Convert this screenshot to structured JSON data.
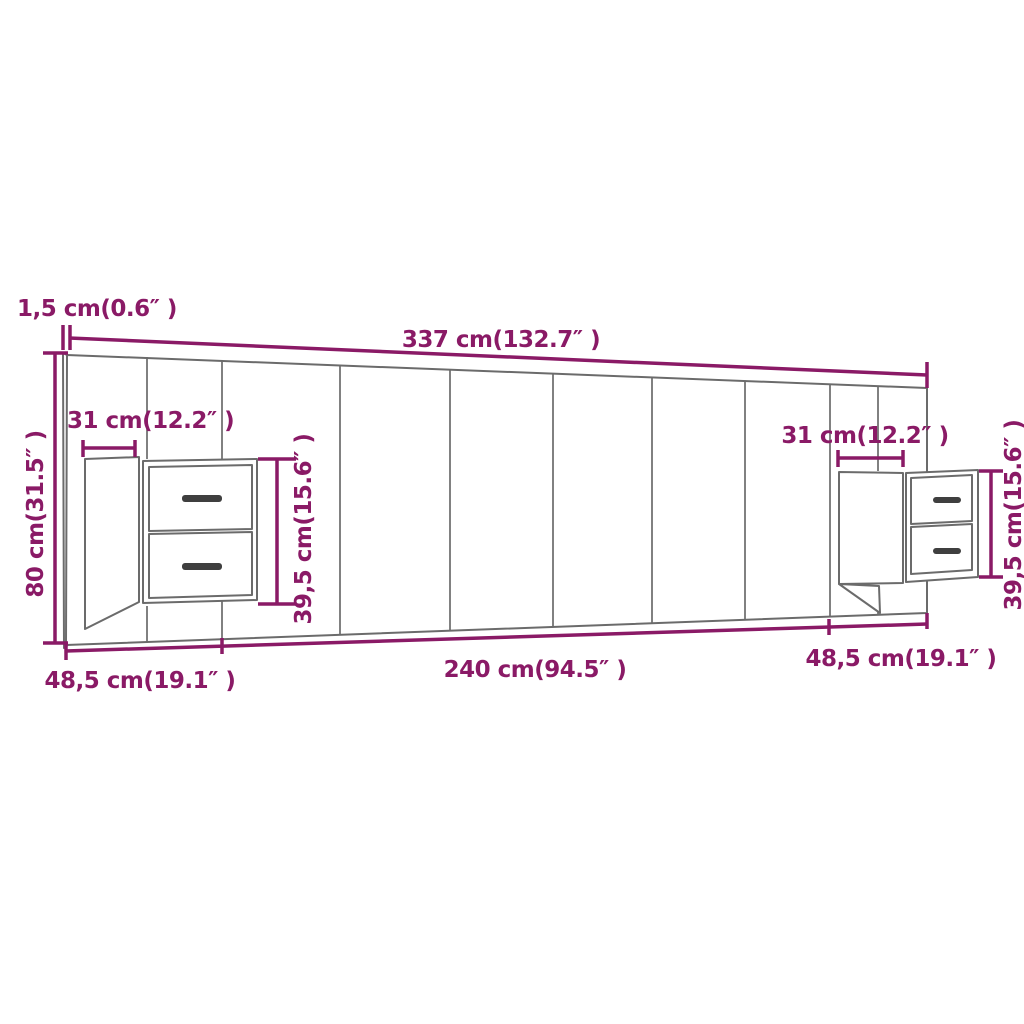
{
  "page": {
    "background": "#ffffff"
  },
  "colors": {
    "dimension_accent": "#8A1A66",
    "furniture_outline": "#6B6B6B",
    "drawer_handle": "#3F3F3F"
  },
  "labels": {
    "panel_thickness": "1,5 cm(0.6″ )",
    "overall_width": "337 cm(132.7″ )",
    "left_cabinet_width": "31 cm(12.2″ )",
    "right_cabinet_width": "31 cm(12.2″ )",
    "overall_height": "80 cm(31.5″ )",
    "left_cabinet_height": "39,5 cm(15.6″ )",
    "right_cabinet_height": "39,5 cm(15.6″ )",
    "center_section_width": "240 cm(94.5″ )",
    "left_section_width": "48,5 cm(19.1″ )",
    "right_section_width": "48,5 cm(19.1″ )"
  }
}
